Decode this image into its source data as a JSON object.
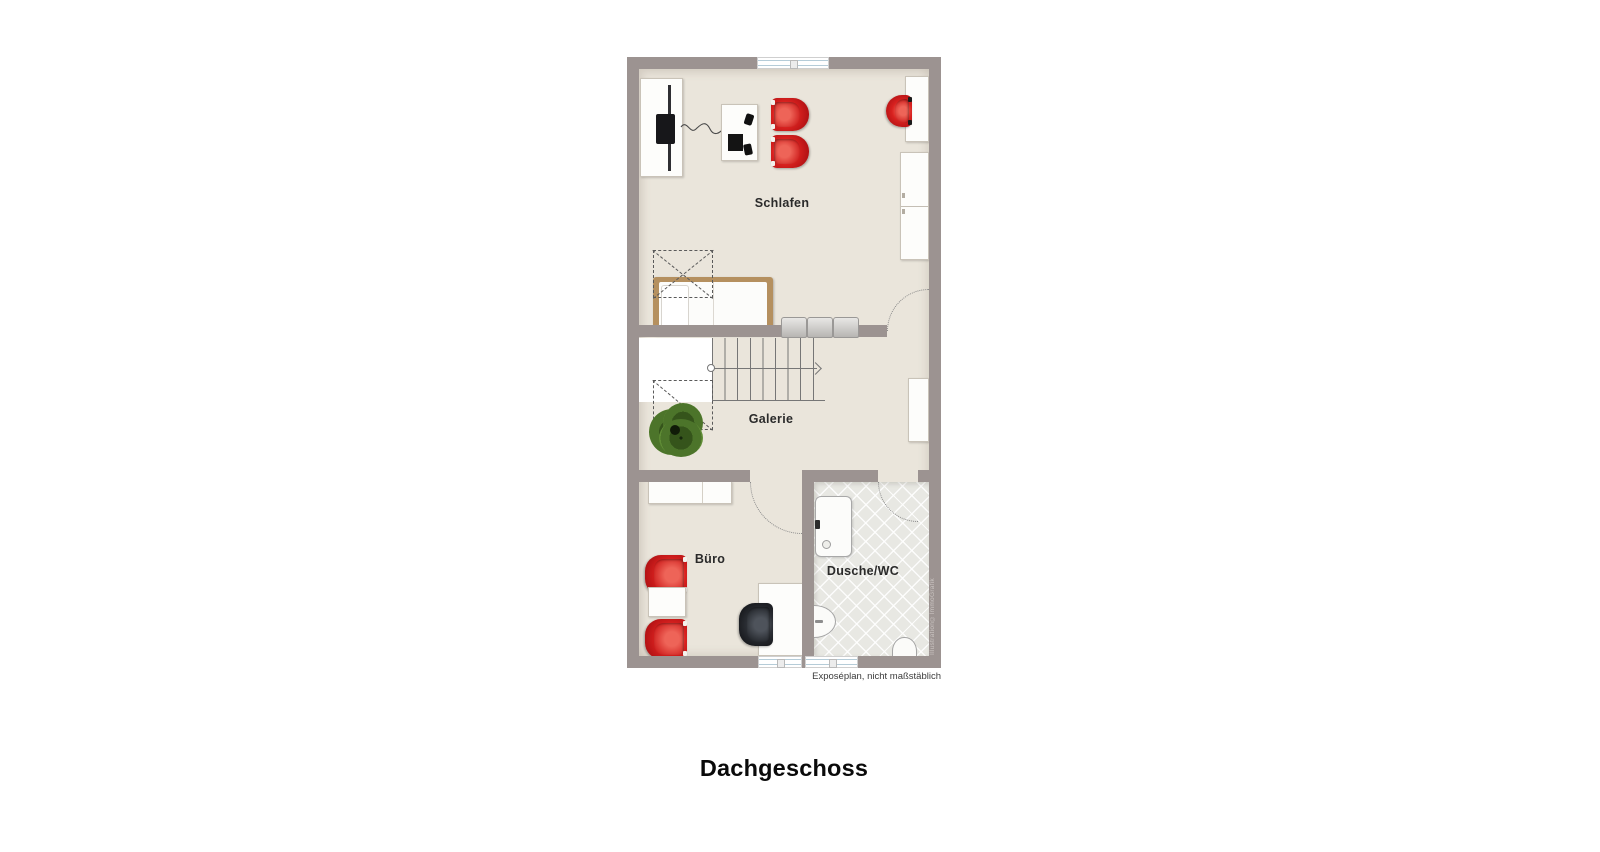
{
  "page": {
    "background": "#ffffff",
    "title": "Dachgeschoss",
    "caption": "Exposéplan, nicht maßstäblich",
    "watermark": "Illustration©ImmoGrafik"
  },
  "floorplan": {
    "type": "floor-plan",
    "rooms": [
      {
        "id": "schlafen",
        "label": "Schlafen"
      },
      {
        "id": "galerie",
        "label": "Galerie"
      },
      {
        "id": "buero",
        "label": "Büro"
      },
      {
        "id": "dusche_wc",
        "label": "Dusche/WC"
      }
    ],
    "features": [
      "staircase-with-direction-arrow",
      "roof-slope-dashed-lines",
      "plant",
      "double-bed",
      "tv-board",
      "media-table",
      "red-armchairs",
      "desks",
      "wardrobe",
      "sideboard",
      "black-office-chair",
      "shower",
      "washbasin",
      "toilet",
      "dresser",
      "windows",
      "door-swing-arcs"
    ],
    "colors": {
      "wall": "#9c9391",
      "floor": "#eae5db",
      "bath_tile": "#e8e8e3",
      "armchair_red": "#c9181b",
      "bed_frame_wood": "#b5905f",
      "window_glass": "#b5ccd8",
      "stair_line": "#767676"
    }
  }
}
